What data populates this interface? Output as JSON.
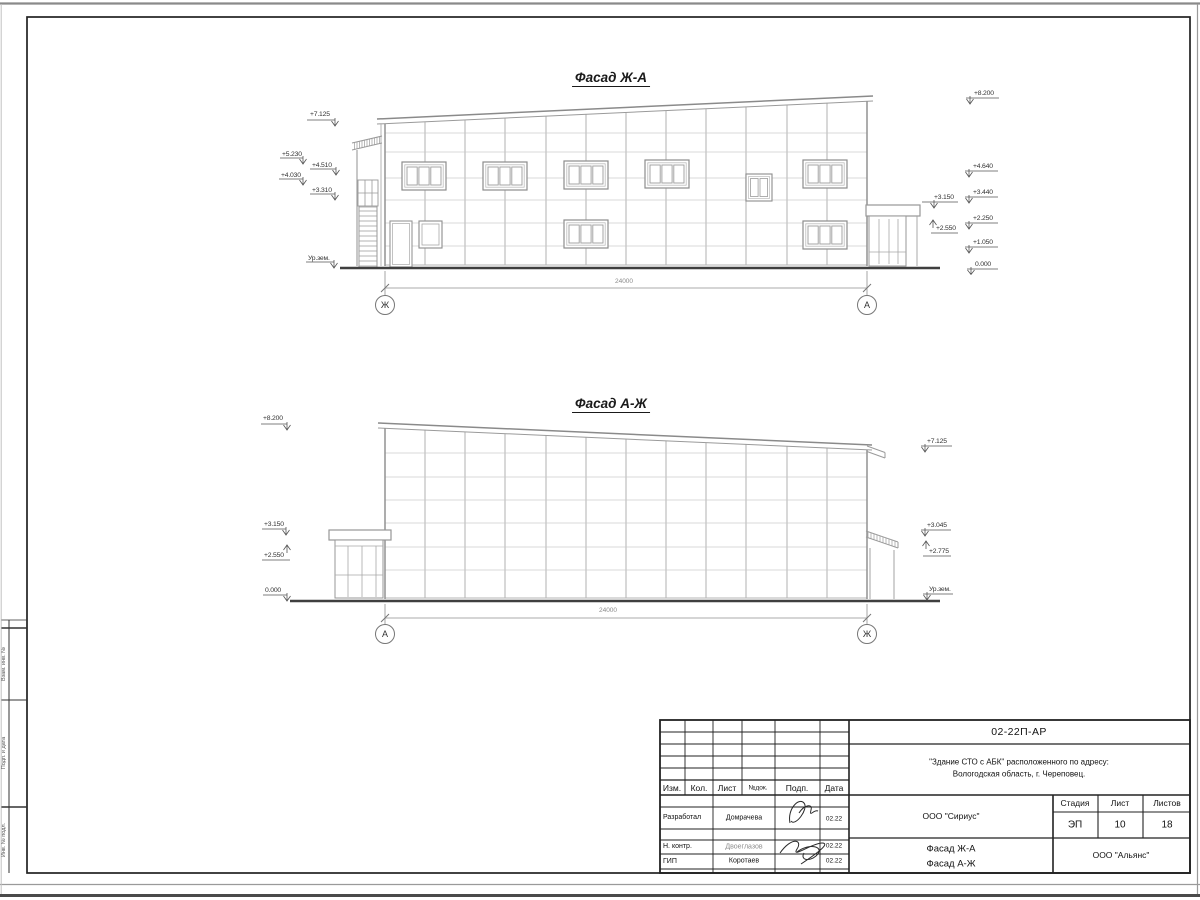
{
  "facade1": {
    "title": "Фасад Ж-А",
    "marks_left": [
      "+7.125",
      "+5.230",
      "+4.510",
      "+4.030",
      "+3.310",
      "Ур.зем."
    ],
    "marks_right": [
      "+8.200",
      "+4.640",
      "+3.440",
      "+3.150",
      "+2.250",
      "+2.550",
      "+1.050",
      "0.000"
    ],
    "dimension": "24000",
    "axis_left": "Ж",
    "axis_right": "А"
  },
  "facade2": {
    "title": "Фасад А-Ж",
    "marks_left": [
      "+8.200",
      "+3.150",
      "+2.550",
      "0.000"
    ],
    "marks_right": [
      "+7.125",
      "+3.045",
      "+2.775",
      "Ур.зем."
    ],
    "dimension": "24000",
    "axis_left": "А",
    "axis_right": "Ж"
  },
  "side_stamp": {
    "labels": [
      "Взам. инв. №",
      "Подп. и дата",
      "Инв. № подл."
    ]
  },
  "title_block": {
    "code": "02-22П-АР",
    "project_line1": "\"Здание СТО с АБК\" расположенного по адресу:",
    "project_line2": "Вологодская область, г. Череповец.",
    "rev_headers": [
      "Изм.",
      "Кол.",
      "Лист",
      "№док.",
      "Подп.",
      "Дата"
    ],
    "rows": [
      {
        "role": "Разработал",
        "name": "Домрачева",
        "date": "02.22"
      },
      {
        "role": "Н. контр.",
        "name": "Двоеглазов",
        "date": "02.22"
      },
      {
        "role": "ГИП",
        "name": "Коротаев",
        "date": "02.22"
      }
    ],
    "org1": "ООО \"Сириус\"",
    "org2": "ООО \"Альянс\"",
    "sheet_title_line1": "Фасад Ж-А",
    "sheet_title_line2": "Фасад А-Ж",
    "stage_label": "Стадия",
    "sheet_label": "Лист",
    "sheets_label": "Листов",
    "stage": "ЭП",
    "sheet_no": "10",
    "sheets_total": "18"
  }
}
